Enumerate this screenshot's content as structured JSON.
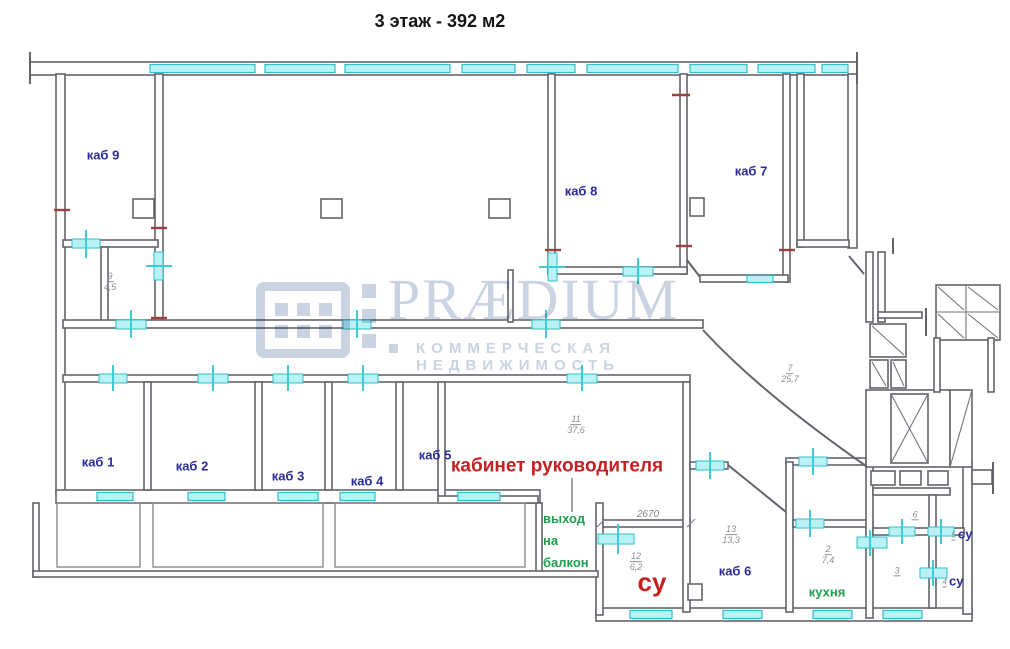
{
  "title": "3 этаж - 392 м2",
  "watermark": {
    "brand": "PRÆDIUM",
    "tagline": "КОММЕРЧЕСКАЯ НЕДВИЖИМОСТЬ"
  },
  "rooms": {
    "kab1": "каб 1",
    "kab2": "каб 2",
    "kab3": "каб 3",
    "kab4": "каб 4",
    "kab5": "каб 5",
    "kab6": "каб 6",
    "kab7": "каб 7",
    "kab8": "каб 8",
    "kab9": "каб 9",
    "director": "кабинет руководителя",
    "balcony_exit": {
      "l1": "выход",
      "l2": "на",
      "l3": "балкон"
    },
    "kitchen": "кухня",
    "su_red": "су",
    "su_blue": "су"
  },
  "room_numbers": {
    "r9": {
      "num": "9",
      "area": "4,5"
    },
    "r11": {
      "num": "11",
      "area": "37,6"
    },
    "r7": {
      "num": "7",
      "area": "25,7"
    },
    "r12": {
      "num": "12",
      "area": "6,2"
    },
    "r13": {
      "num": "13",
      "area": "13,3"
    },
    "r2": {
      "num": "2",
      "area": "7,4"
    },
    "r6": {
      "num": "6"
    },
    "r3": {
      "num": "3"
    },
    "r5": {
      "num": "5"
    },
    "r4": {
      "num": "4"
    }
  },
  "dimension_2670": "2670",
  "colors": {
    "wall": "#63636b",
    "window_fill": "#b9f2f4",
    "window_stroke": "#2fbfca",
    "label_blue": "#2b2b9b",
    "label_red": "#c42222",
    "label_green": "#1f9e4b",
    "number_gray": "#8d8d99",
    "watermark": "#c9d3e2"
  }
}
